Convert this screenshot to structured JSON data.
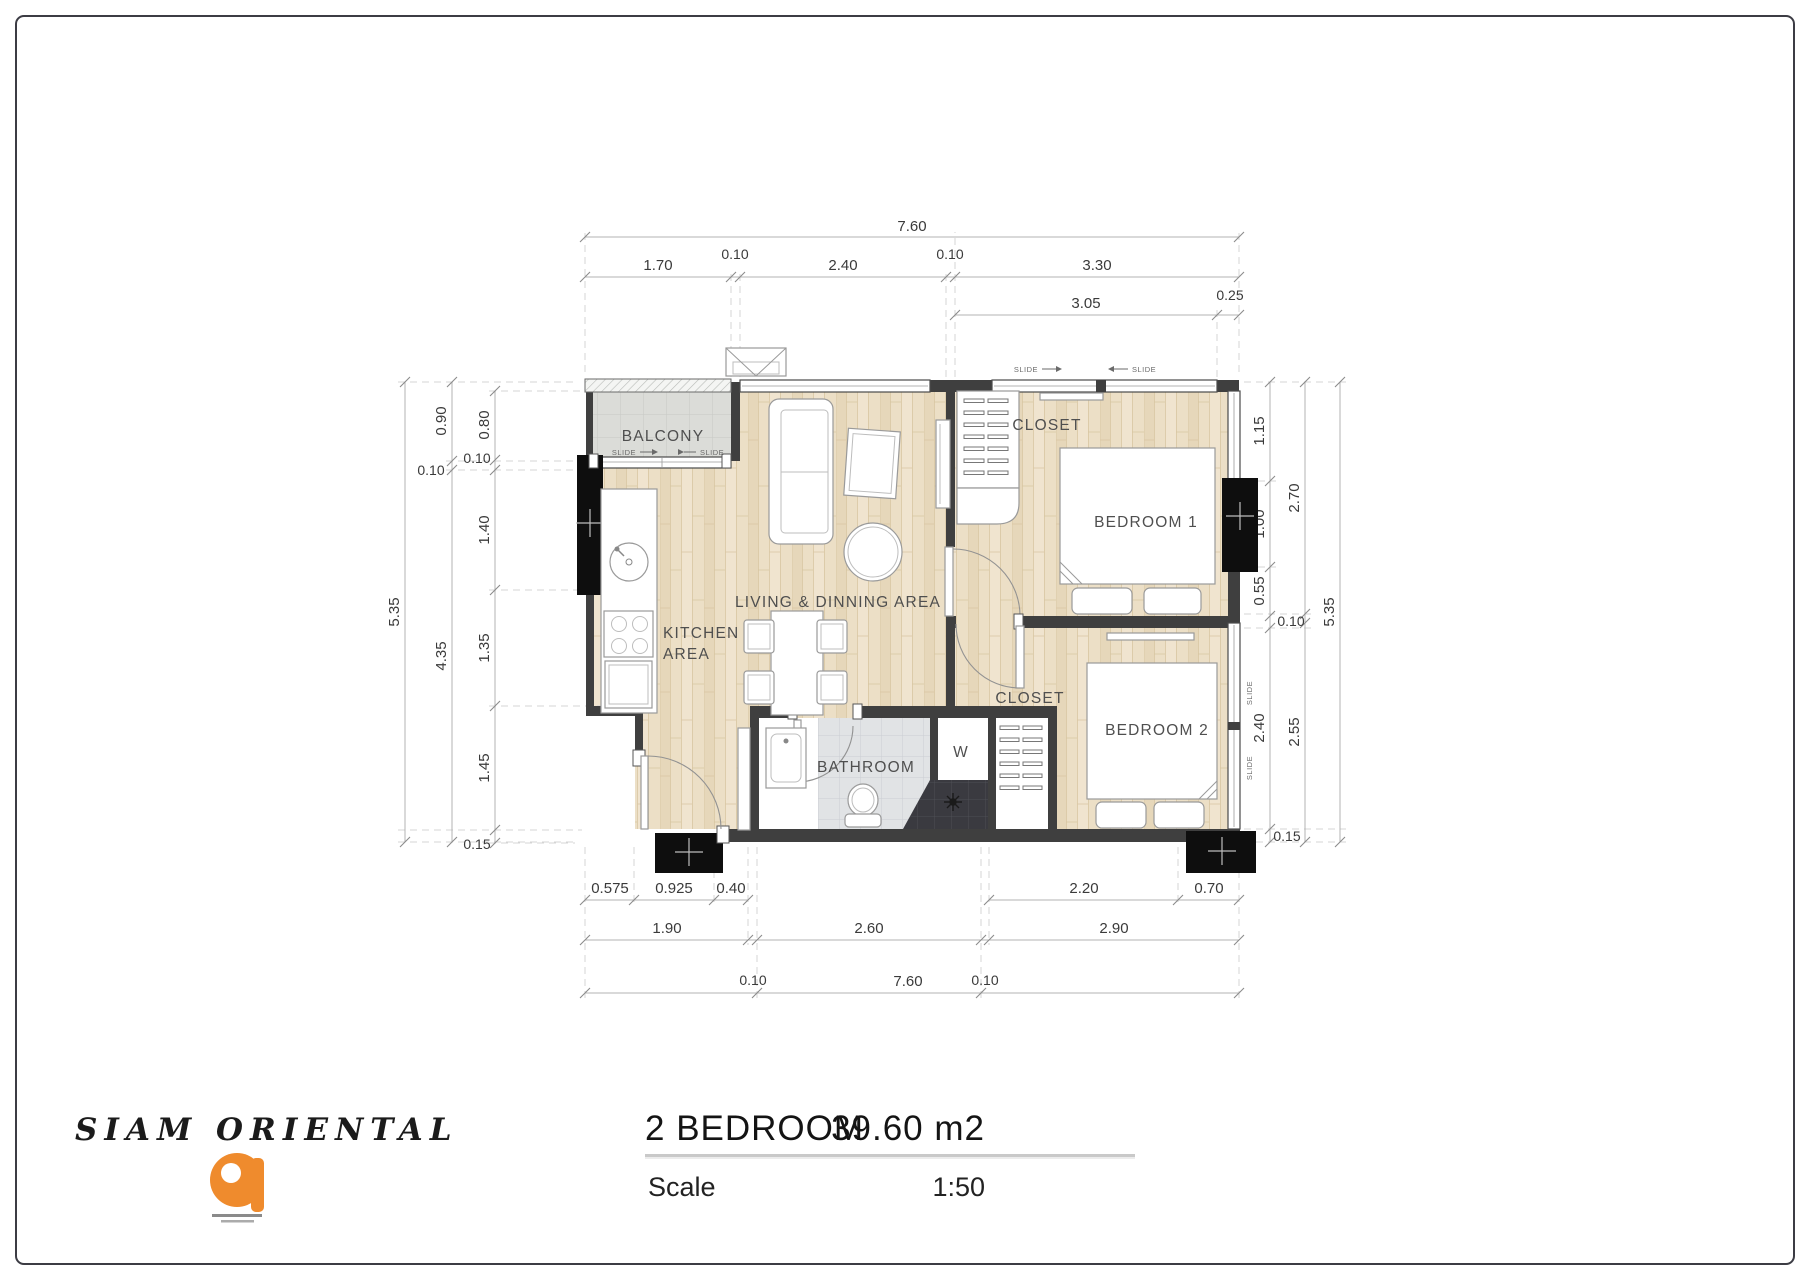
{
  "sheet": {
    "title_block": {
      "project_name": "SIAM ORIENTAL",
      "unit_type": "2 BEDROOM",
      "unit_area": "39.60 m2",
      "scale_label": "Scale",
      "scale_value": "1:50"
    },
    "rooms": {
      "balcony": "BALCONY",
      "living": "LIVING & DINNING AREA",
      "kitchen_line1": "KITCHEN",
      "kitchen_line2": "AREA",
      "bathroom": "BATHROOM",
      "closet_top": "CLOSET",
      "closet_lower": "CLOSET",
      "bedroom1": "BEDROOM 1",
      "bedroom2": "BEDROOM 2",
      "washer": "W"
    },
    "annotations": {
      "slide": "SLIDE"
    },
    "dimensions": {
      "top": [
        "7.60",
        "1.70",
        "0.10",
        "2.40",
        "0.10",
        "3.30",
        "3.05",
        "0.25"
      ],
      "left": [
        "5.35",
        "0.90",
        "0.10",
        "0.80",
        "0.10",
        "4.35",
        "1.40",
        "1.35",
        "1.45",
        "0.15"
      ],
      "right": [
        "1.15",
        "1.00",
        "0.55",
        "0.10",
        "2.40",
        "0.15",
        "2.70",
        "2.55",
        "5.35"
      ],
      "bottom": [
        "0.575",
        "0.925",
        "0.40",
        "2.20",
        "0.70",
        "1.90",
        "2.60",
        "2.90",
        "0.10",
        "7.60",
        "0.10"
      ]
    },
    "colors": {
      "logo_orange": "#ef8b2d",
      "wall": "#3f3f3f"
    }
  }
}
